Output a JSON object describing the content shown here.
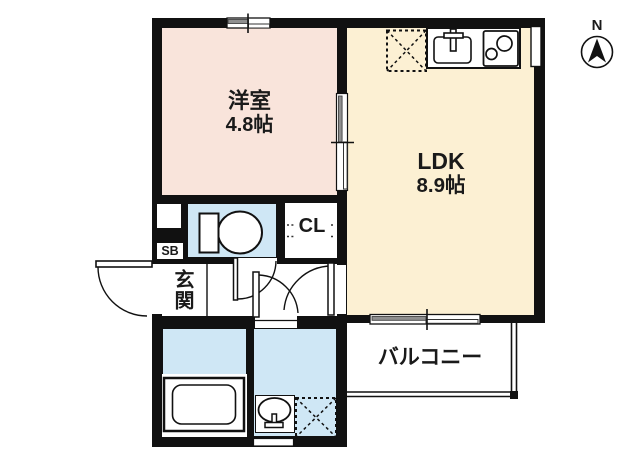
{
  "plan": {
    "type": "apartment-floor-plan",
    "north_label": "N",
    "rooms": {
      "western_room": {
        "name": "洋室",
        "area": "4.8帖"
      },
      "ldk": {
        "name": "LDK",
        "area": "8.9帖"
      },
      "closet": {
        "label": "CL"
      },
      "entrance": {
        "label": "玄関"
      },
      "shoe_box": {
        "label": "SB"
      },
      "balcony": {
        "label": "バルコニー"
      }
    },
    "fixtures": [
      "refrigerator-space",
      "kitchen-sink",
      "stove",
      "toilet",
      "closet-pipe",
      "bathtub",
      "washbasin",
      "washing-machine-space"
    ],
    "colors": {
      "wall": "#111111",
      "western_room_fill": "#f9e4db",
      "ldk_fill": "#fcf0d3",
      "wet_area_fill": "#cfe7f5",
      "window_pane_gray": "#8f8f8f"
    }
  }
}
